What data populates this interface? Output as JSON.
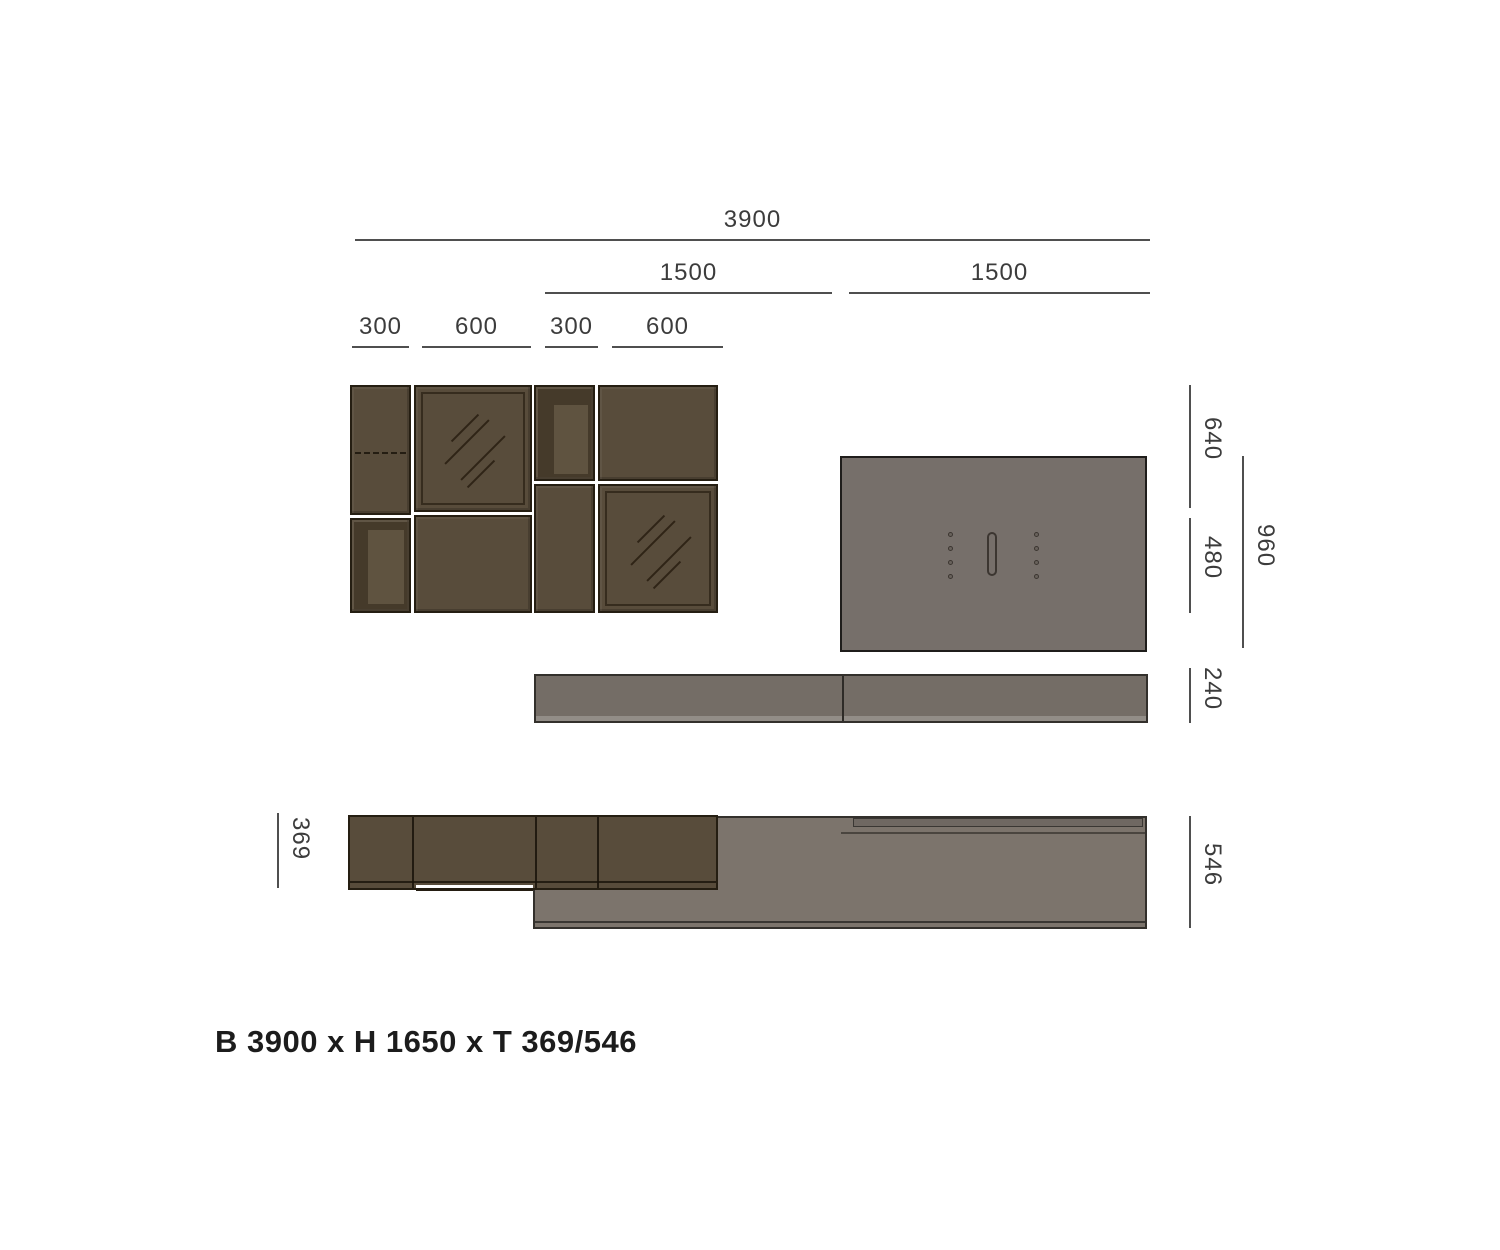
{
  "title": "B 3900 x H 1650 x T 369/546",
  "dims": {
    "total_width": "3900",
    "panel_left_width": "1500",
    "panel_right_width": "1500",
    "col1_width": "300",
    "col2_width": "600",
    "col3_width": "300",
    "col4_width": "600",
    "top_row_height": "640",
    "bottom_row_height": "480",
    "panel_height": "960",
    "shelf_height": "240",
    "cabinet_depth": "369",
    "lowboard_depth": "546"
  },
  "colors": {
    "background": "#FFFFFF",
    "cabinet_brown": "#584C3B",
    "cabinet_outline": "#251E12",
    "cabinet_interior_shadow": "#453A2A",
    "cabinet_interior_back": "#5F5340",
    "panel_gray": "#766F6A",
    "panel_outline": "#1F1D1B",
    "shelf_gray": "#746D66",
    "plan_gray": "#7C746C",
    "dim_line": "#4F4F4F",
    "dim_text": "#3C3C3C",
    "title_text": "#1C1C1C"
  }
}
